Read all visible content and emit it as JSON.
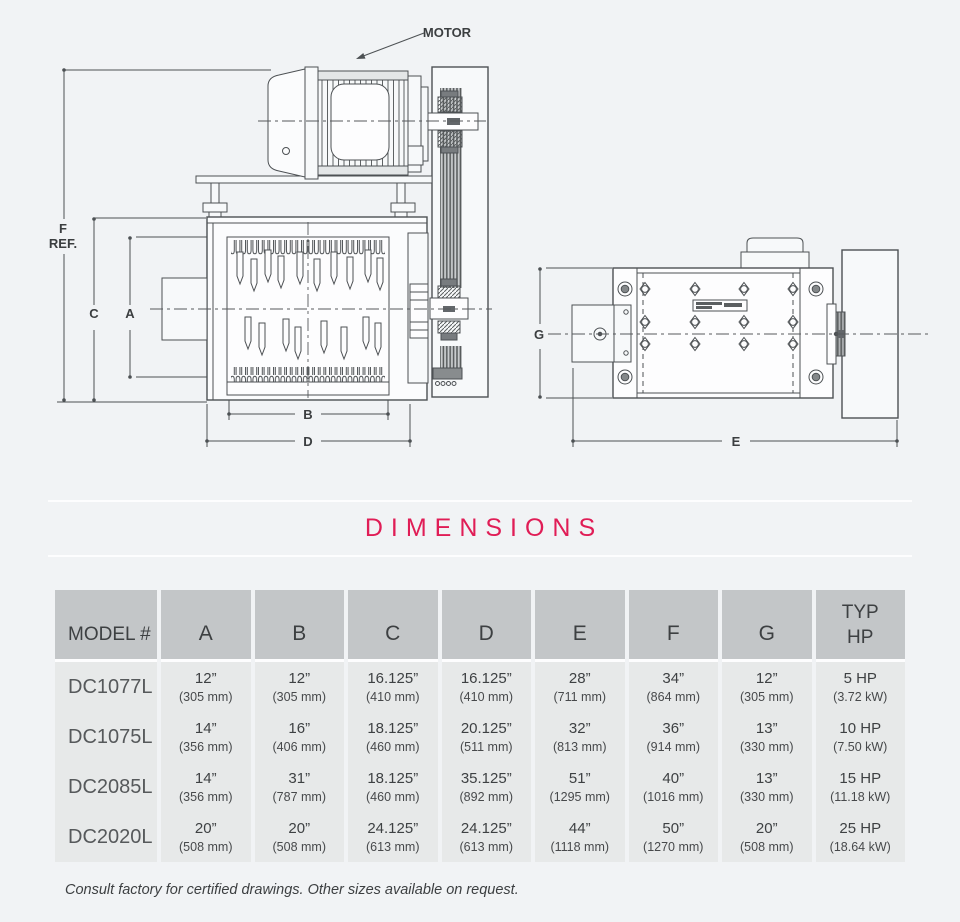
{
  "drawing": {
    "motor_label": "MOTOR",
    "dims": {
      "f1": "F",
      "f2": "REF.",
      "c": "C",
      "a": "A",
      "b": "B",
      "d": "D",
      "g": "G",
      "e": "E"
    }
  },
  "section": {
    "title": "DIMENSIONS"
  },
  "table": {
    "headers": {
      "model": "MODEL #",
      "a": "A",
      "b": "B",
      "c": "C",
      "d": "D",
      "e": "E",
      "f": "F",
      "g": "G",
      "hp1": "TYP",
      "hp2": "HP"
    },
    "rows": [
      {
        "model": "DC1077L",
        "cells": [
          {
            "v": "12”",
            "m": "(305 mm)"
          },
          {
            "v": "12”",
            "m": "(305 mm)"
          },
          {
            "v": "16.125”",
            "m": "(410 mm)"
          },
          {
            "v": "16.125”",
            "m": "(410 mm)"
          },
          {
            "v": "28”",
            "m": "(711 mm)"
          },
          {
            "v": "34”",
            "m": "(864 mm)"
          },
          {
            "v": "12”",
            "m": "(305 mm)"
          },
          {
            "v": "5 HP",
            "m": "(3.72 kW)"
          }
        ]
      },
      {
        "model": "DC1075L",
        "cells": [
          {
            "v": "14”",
            "m": "(356 mm)"
          },
          {
            "v": "16”",
            "m": "(406 mm)"
          },
          {
            "v": "18.125”",
            "m": "(460 mm)"
          },
          {
            "v": "20.125”",
            "m": "(511 mm)"
          },
          {
            "v": "32”",
            "m": "(813 mm)"
          },
          {
            "v": "36”",
            "m": "(914 mm)"
          },
          {
            "v": "13”",
            "m": "(330 mm)"
          },
          {
            "v": "10 HP",
            "m": "(7.50 kW)"
          }
        ]
      },
      {
        "model": "DC2085L",
        "cells": [
          {
            "v": "14”",
            "m": "(356 mm)"
          },
          {
            "v": "31”",
            "m": "(787 mm)"
          },
          {
            "v": "18.125”",
            "m": "(460 mm)"
          },
          {
            "v": "35.125”",
            "m": "(892 mm)"
          },
          {
            "v": "51”",
            "m": "(1295 mm)"
          },
          {
            "v": "40”",
            "m": "(1016 mm)"
          },
          {
            "v": "13”",
            "m": "(330 mm)"
          },
          {
            "v": "15 HP",
            "m": "(11.18 kW)"
          }
        ]
      },
      {
        "model": "DC2020L",
        "cells": [
          {
            "v": "20”",
            "m": "(508 mm)"
          },
          {
            "v": "20”",
            "m": "(508 mm)"
          },
          {
            "v": "24.125”",
            "m": "(613 mm)"
          },
          {
            "v": "24.125”",
            "m": "(613 mm)"
          },
          {
            "v": "44”",
            "m": "(1118 mm)"
          },
          {
            "v": "50”",
            "m": "(1270 mm)"
          },
          {
            "v": "20”",
            "m": "(508 mm)"
          },
          {
            "v": "25 HP",
            "m": "(18.64 kW)"
          }
        ]
      }
    ]
  },
  "footnote": {
    "text": "Consult factory for certified drawings. Other sizes available on request."
  },
  "colors": {
    "accent": "#e01d56",
    "table_header_bg": "#c3c6c8",
    "table_row_bg": "#e7e9e9",
    "line": "#4d5154",
    "page_bg": "#f1f3f5"
  }
}
